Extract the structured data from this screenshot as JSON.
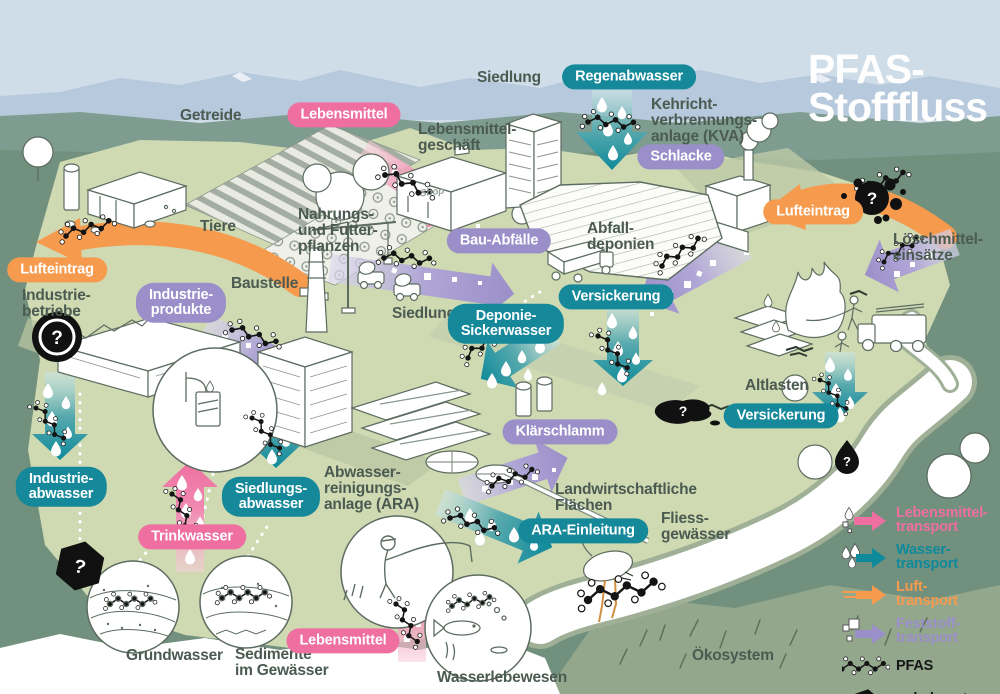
{
  "title": {
    "text": "PFAS-\nStofffluss"
  },
  "icons": {
    "question_mark": "?"
  },
  "labels": {
    "getreide": {
      "text": "Getreide"
    },
    "siedlung_top": {
      "text": "Siedlung"
    },
    "lebensmittelgeschaeft": {
      "text": "Lebensmittel-\ngeschäft"
    },
    "shop_sign": {
      "text": "Shop"
    },
    "tiere": {
      "text": "Tiere"
    },
    "nahrungs_futterpflanzen": {
      "text": "Nahrungs-\nund Futter-\npflanzen"
    },
    "kva": {
      "text": "Kehricht-\nverbrennungs-\nanlage (KVA)"
    },
    "loeschmitteleinsaetze": {
      "text": "Löschmittel-\neinsätze"
    },
    "industriebetriebe": {
      "text": "Industrie-\nbetriebe"
    },
    "baustelle": {
      "text": "Baustelle"
    },
    "siedlung_mitte": {
      "text": "Siedlung"
    },
    "abfalldeponien": {
      "text": "Abfall-\ndeponien"
    },
    "altlasten": {
      "text": "Altlasten"
    },
    "ara": {
      "text": "Abwasser-\nreinigungs-\nanlage (ARA)"
    },
    "landwirtschaftliche_flaechen": {
      "text": "Landwirtschaftliche\nFlächen"
    },
    "fliessgewaesser": {
      "text": "Fliess-\ngewässer"
    },
    "grundwasser": {
      "text": "Grundwasser"
    },
    "sedimente": {
      "text": "Sedimente\nim Gewässer"
    },
    "wasserlebewesen": {
      "text": "Wasserlebewesen"
    },
    "oekosystem": {
      "text": "Ökosystem"
    }
  },
  "pills": {
    "lebensmittel_oben": {
      "text": "Lebensmittel"
    },
    "regenabwasser": {
      "text": "Regenabwasser"
    },
    "schlacke": {
      "text": "Schlacke"
    },
    "lufteintrag_rechts": {
      "text": "Lufteintrag"
    },
    "lufteintrag_links": {
      "text": "Lufteintrag"
    },
    "industrieprodukte": {
      "text": "Industrie-\nprodukte"
    },
    "bauabfaelle": {
      "text": "Bau-Abfälle"
    },
    "versickerung_mitte": {
      "text": "Versickerung"
    },
    "deponiesickerwasser": {
      "text": "Deponie-\nSickerwasser"
    },
    "klaerschlamm": {
      "text": "Klärschlamm"
    },
    "versickerung_rechts": {
      "text": "Versickerung"
    },
    "industrieabwasser": {
      "text": "Industrie-\nabwasser"
    },
    "siedlungsabwasser": {
      "text": "Siedlungs-\nabwasser"
    },
    "trinkwasser": {
      "text": "Trinkwasser"
    },
    "ara_einleitung": {
      "text": "ARA-Einleitung"
    },
    "lebensmittel_unten": {
      "text": "Lebensmittel"
    }
  },
  "legend": {
    "lebensmittel": {
      "text": "Lebensmittel-\ntransport"
    },
    "wasser": {
      "text": "Wasser-\ntransport"
    },
    "luft": {
      "text": "Luft-\ntransport"
    },
    "feststoff": {
      "text": "Feststoff-\ntransport"
    },
    "pfas": {
      "text": "PFAS"
    },
    "unbekannt": {
      "text": "unbekannte\nQuellen"
    }
  },
  "colors": {
    "pink": "#EE6FA0",
    "teal": "#15889A",
    "orange": "#F69A4E",
    "purple": "#9B8FC9"
  }
}
